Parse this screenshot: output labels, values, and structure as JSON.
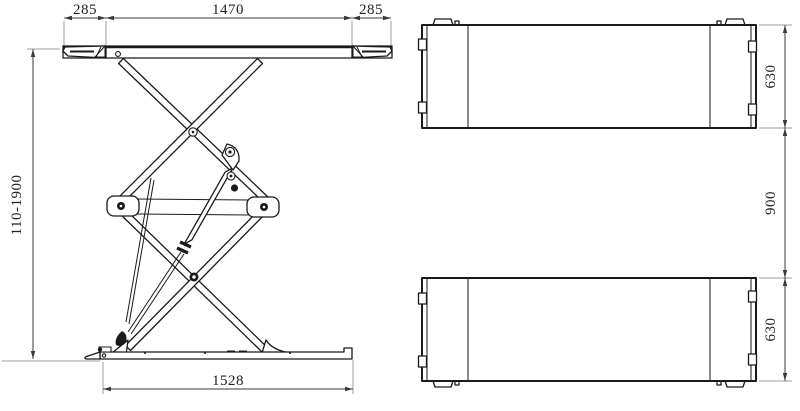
{
  "drawing": {
    "title": "Scissor lift technical drawing, two orthographic views",
    "colors": {
      "object_line": "#1a1a1a",
      "dimension_line": "#3a3a3a",
      "extension_line": "#9e9e9e",
      "background": "#ffffff",
      "text": "#222222"
    },
    "side_view": {
      "name": "side-elevation-view",
      "dimensions": {
        "left_ramp": "285",
        "platform_length": "1470",
        "right_ramp": "285",
        "lift_height_range": "110-1900",
        "base_length": "1528"
      }
    },
    "plan_view": {
      "name": "plan-top-view",
      "dimensions": {
        "top_platform_width": "630",
        "platform_gap": "900",
        "bottom_platform_width": "630"
      }
    }
  }
}
